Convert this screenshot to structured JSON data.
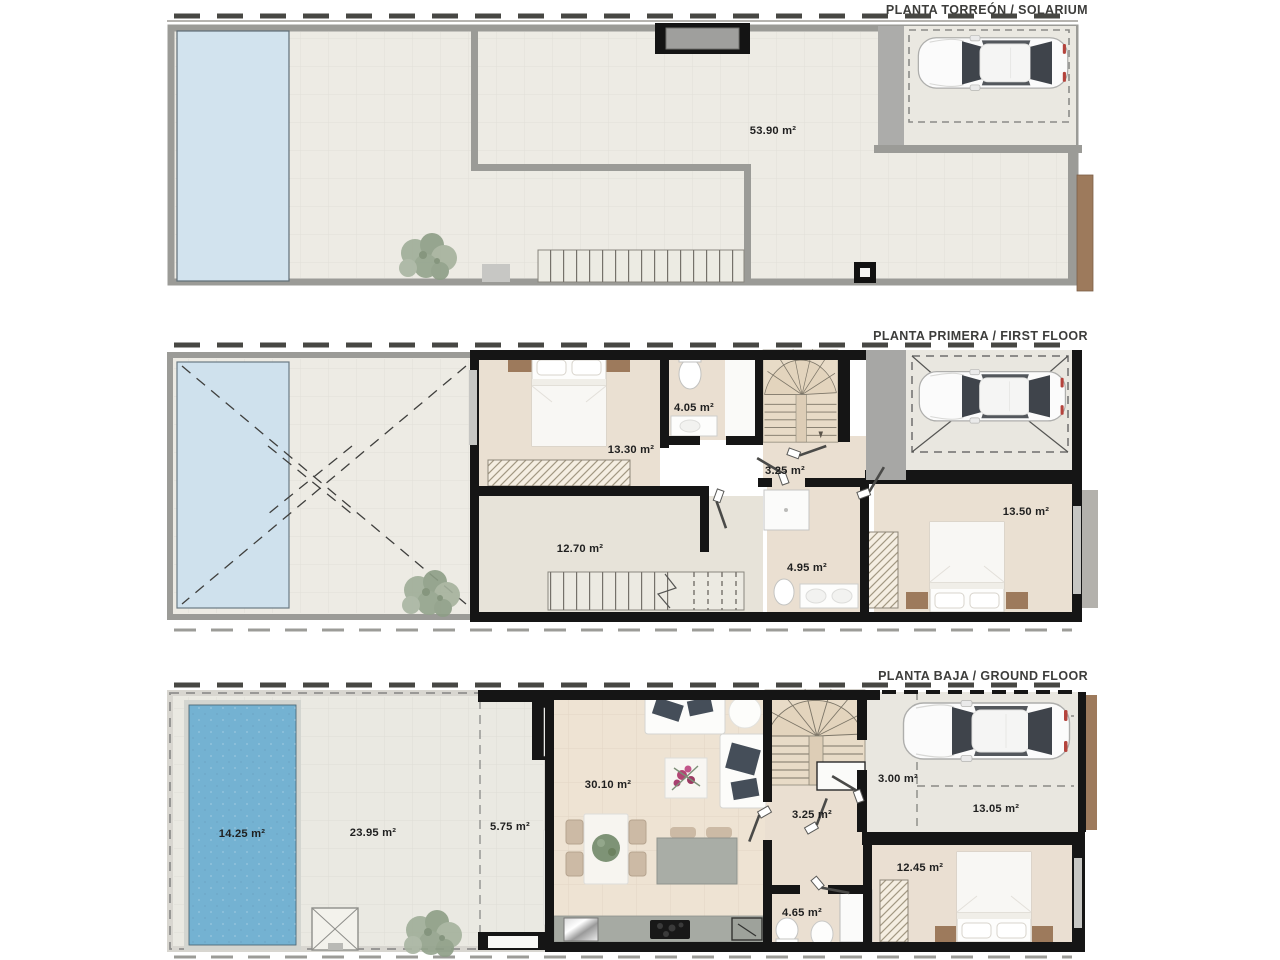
{
  "document": {
    "type": "floor-plan-sheet",
    "floors": 3
  },
  "plans": [
    {
      "title": "PLANTA TORREÓN / SOLARIUM",
      "areas": {
        "solarium": "53.90 m²"
      }
    },
    {
      "title": "PLANTA PRIMERA / FIRST FLOOR",
      "areas": {
        "bedroom_main": "13.30 m²",
        "ensuite": "4.05 m²",
        "hall": "3.25 m²",
        "landing_room": "12.70 m²",
        "bathroom": "4.95 m²",
        "bedroom_2": "13.50 m²"
      }
    },
    {
      "title": "PLANTA BAJA / GROUND FLOOR",
      "areas": {
        "pool": "14.25 m²",
        "garden": "23.95 m²",
        "porch": "5.75 m²",
        "living_kitchen": "30.10 m²",
        "hall": "3.25 m²",
        "entry": "3.00 m²",
        "garage": "13.05 m²",
        "bedroom": "12.45 m²",
        "bathroom": "4.65 m²"
      }
    }
  ],
  "colors": {
    "wall_dark": "#151515",
    "wall_gray": "#9b9b97",
    "terrace_floor": "#edebe4",
    "interior_warm": "#eadfd1",
    "interior_cool": "#e7e3d9",
    "living_floor": "#eee3d3",
    "garage_floor": "#e9e7e0",
    "stair_floor": "#e8dbc7",
    "pool_light": "#cfe1ed",
    "pool_deep": "#74b2d2",
    "concrete": "#a9a9a7",
    "wood_brown": "#9d7a5c",
    "cushion_dark": "#454e59",
    "plant_green": "#93a38e",
    "counter_gray": "#a6aaa3",
    "label_text": "#1f1f1f",
    "title_text": "#3d3d3b"
  }
}
